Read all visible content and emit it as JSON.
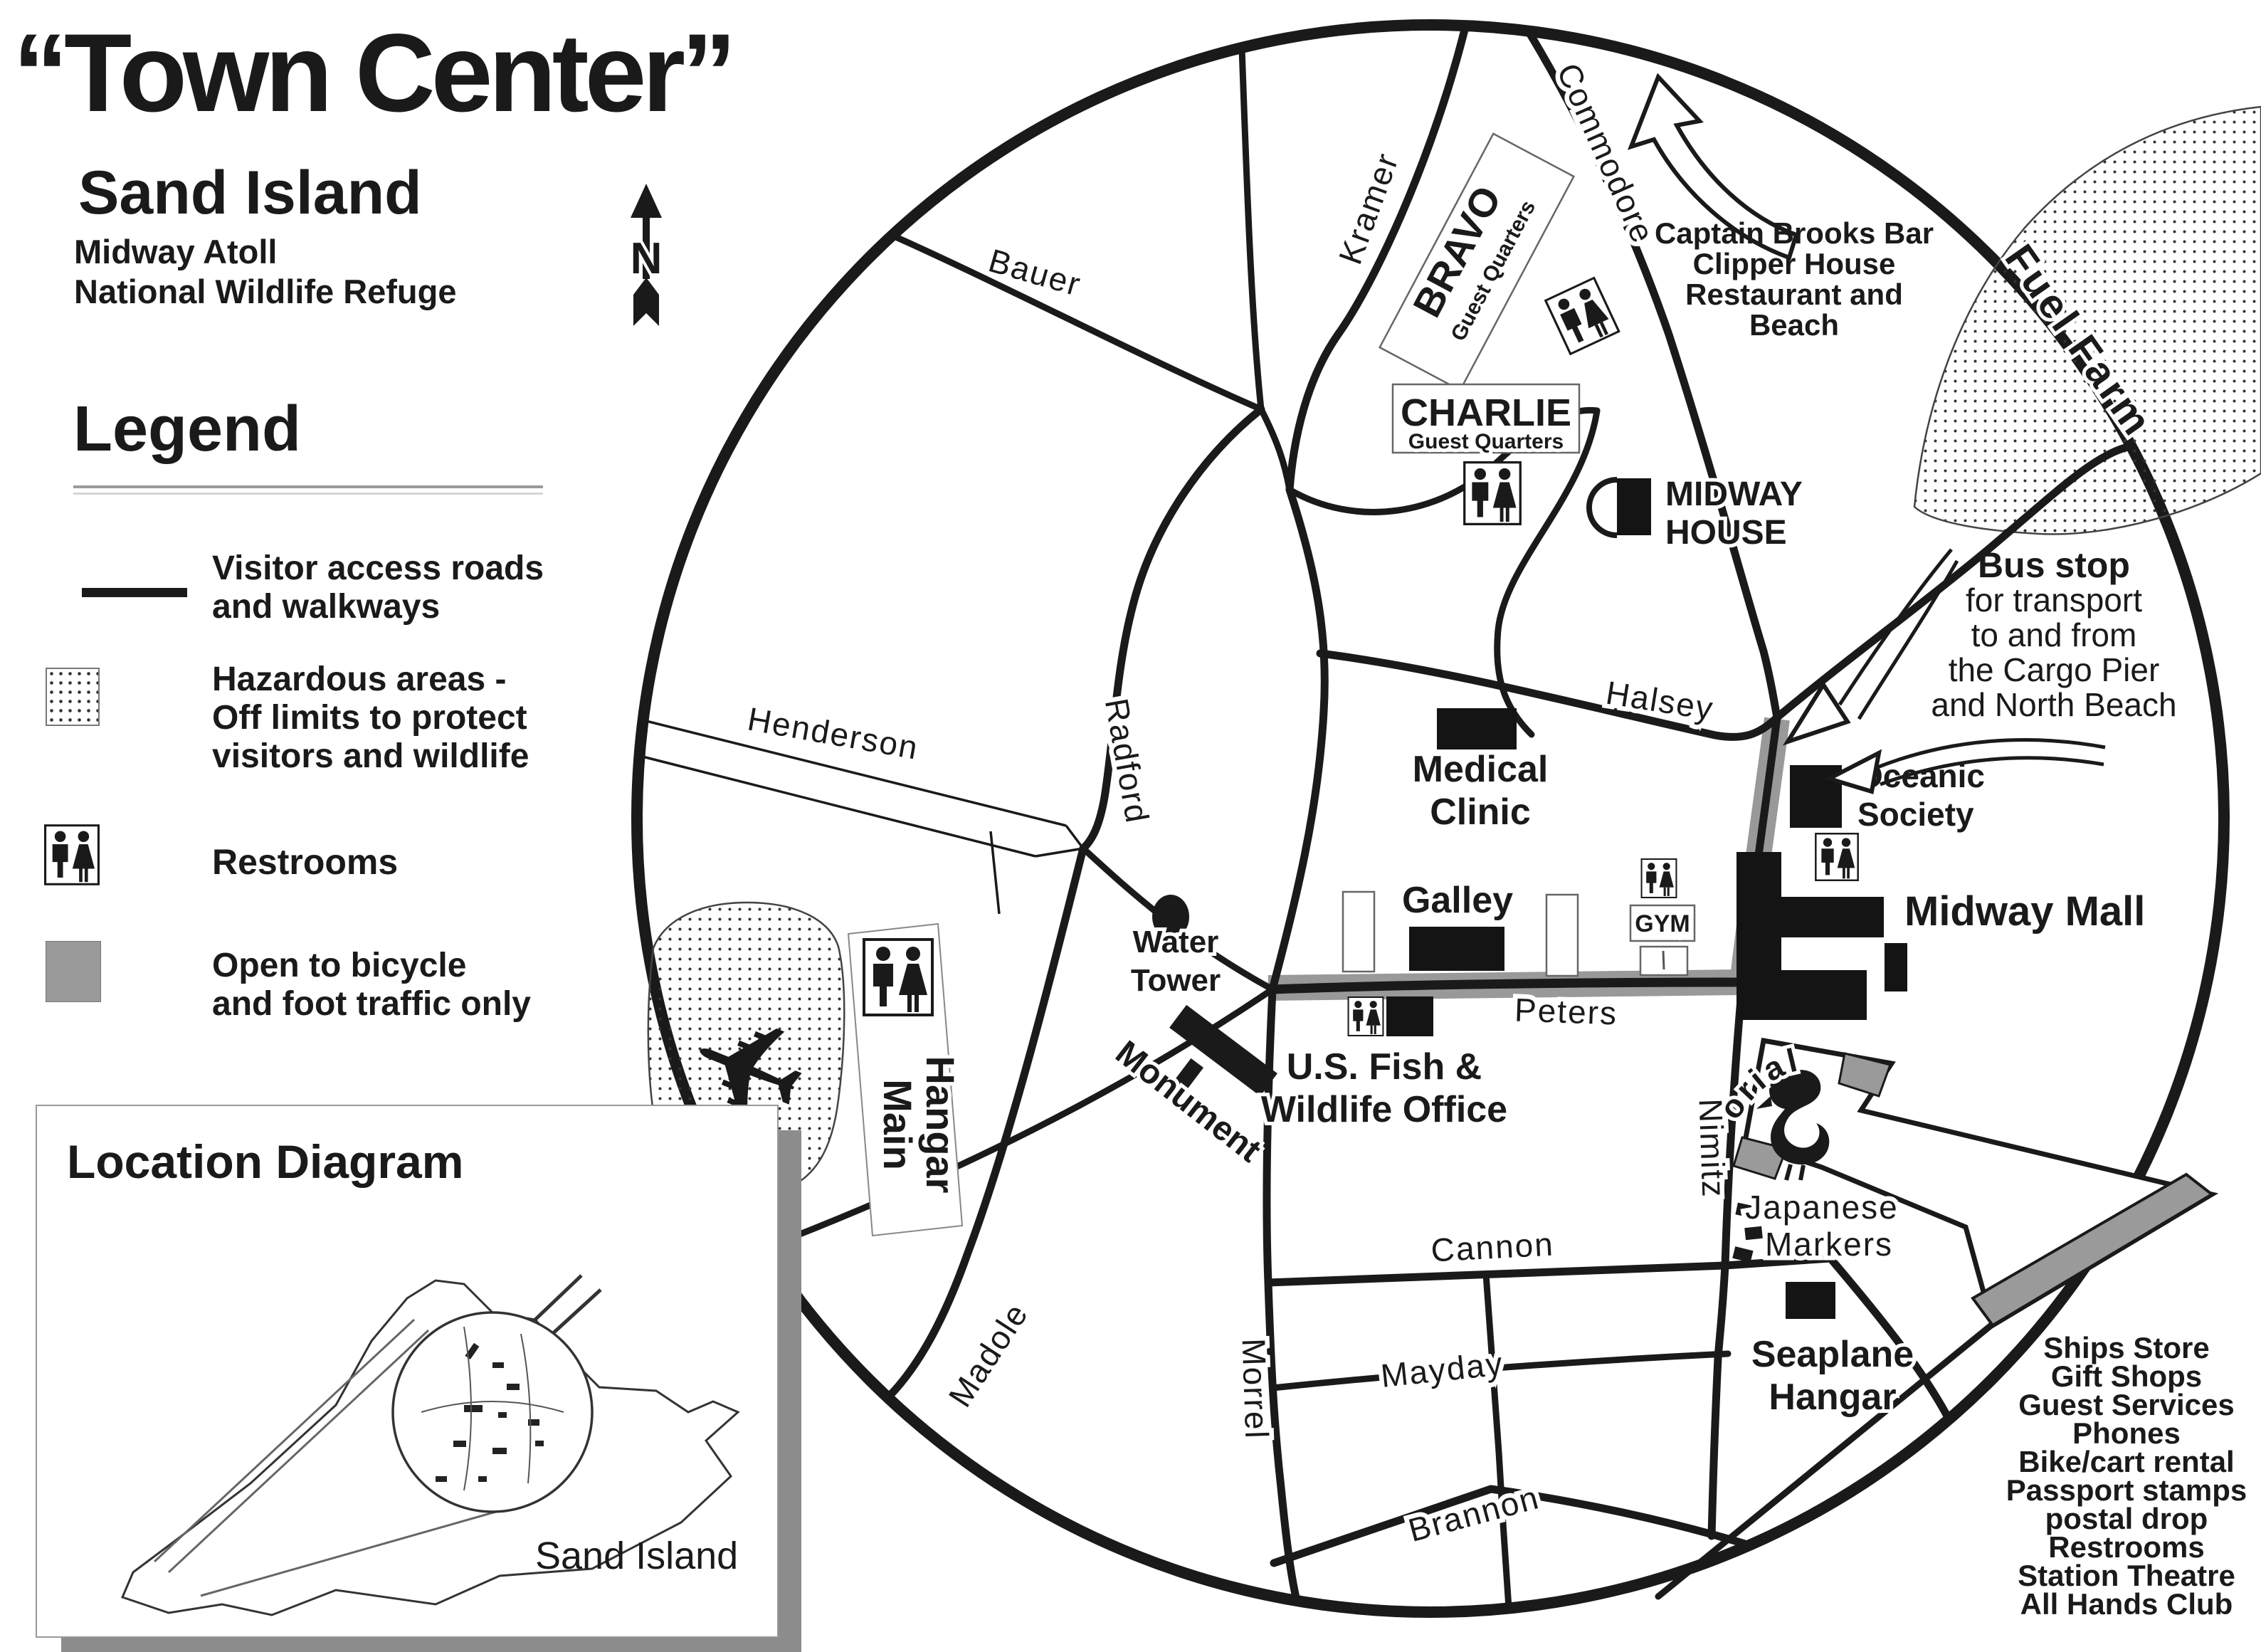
{
  "header": {
    "title": "“Town Center”",
    "subtitle": "Sand Island",
    "line1": "Midway Atoll",
    "line2": "National Wildlife Refuge",
    "north": "N"
  },
  "legend": {
    "heading": "Legend",
    "visitor1": "Visitor access roads",
    "visitor2": "and walkways",
    "hazard1": "Hazardous areas -",
    "hazard2": "Off limits to protect",
    "hazard3": "visitors and wildlife",
    "restrooms": "Restrooms",
    "bike1": "Open to bicycle",
    "bike2": "and foot traffic only"
  },
  "location": {
    "heading": "Location Diagram",
    "island": "Sand Island"
  },
  "roads": {
    "bauer": "Bauer",
    "kramer": "Kramer",
    "commodore": "Commodore",
    "radford": "Radford",
    "henderson": "Henderson",
    "halsey": "Halsey",
    "peters": "Peters",
    "nimitz": "Nimitz",
    "cannon": "Cannon",
    "mayday": "Mayday",
    "morrel": "Morrel",
    "brannon": "Brannon",
    "madole": "Madole",
    "memorial": "Memorial"
  },
  "places": {
    "bravo": "BRAVO",
    "bravo_sub": "Guest Quarters",
    "charlie": "CHARLIE",
    "charlie_sub": "Guest Quarters",
    "midway_house1": "MIDWAY",
    "midway_house2": "HOUSE",
    "medical1": "Medical",
    "medical2": "Clinic",
    "galley": "Galley",
    "gym": "GYM",
    "water1": "Water",
    "water2": "Tower",
    "monument": "Monument",
    "hangar_left": "Main",
    "hangar_right": "Hangar",
    "fuel": "Fuel Farm",
    "oceanic1": "Oceanic",
    "oceanic2": "Society",
    "mall": "Midway Mall",
    "japanese1": "Japanese",
    "japanese2": "Markers",
    "seaplane1": "Seaplane",
    "seaplane2": "Hangar",
    "usfw1": "U.S. Fish &",
    "usfw2": "Wildlife Office"
  },
  "annotations": {
    "captain": [
      "Captain Brooks Bar",
      "Clipper House",
      "Restaurant and",
      "Beach"
    ],
    "bus": [
      "Bus stop",
      "for transport",
      "to and from",
      "the Cargo Pier",
      "and North Beach"
    ],
    "services": [
      "Ships Store",
      "Gift Shops",
      "Guest Services",
      "Phones",
      "Bike/cart rental",
      "Passport stamps",
      "postal drop",
      "Restrooms",
      "Station Theatre",
      "All Hands Club"
    ]
  },
  "colors": {
    "ink": "#1a1a1a",
    "bike_route": "#999999",
    "shadow": "#8c8c8c",
    "building": "#141414"
  }
}
